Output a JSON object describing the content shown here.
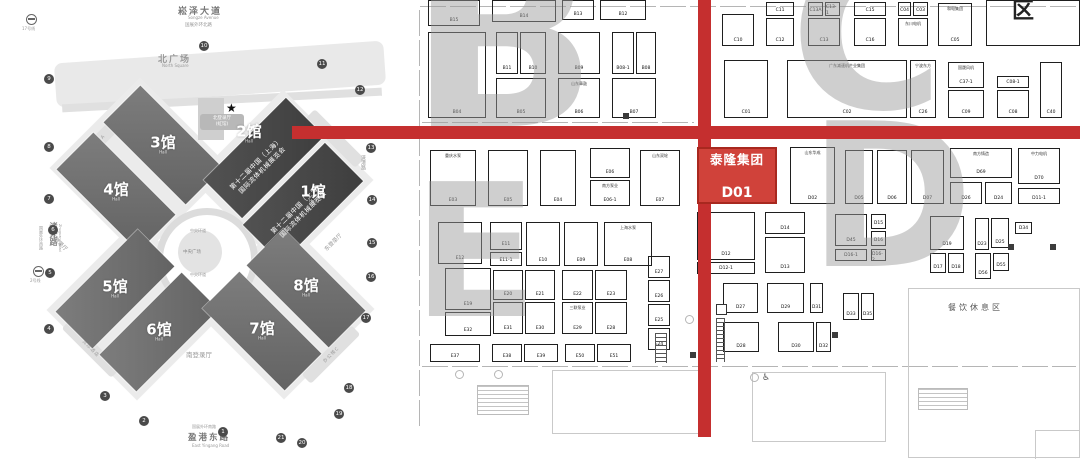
{
  "page": {
    "background": "#ffffff",
    "accent_red": "#c52f2f",
    "booth_red": "#d0423a"
  },
  "left_map": {
    "roads": {
      "top": "崧泽大道",
      "top_en": "Songze Avenue",
      "top_ring": "国展外环北路",
      "left": "诸光路",
      "left_en": "Zhuguang Road",
      "left_ring": "国展外环西路",
      "right": "涞港路",
      "bottom_ring": "国展外环南路",
      "bottom": "盈港东路",
      "bottom_en": "East Yingang Road"
    },
    "squares": {
      "north": "北广场",
      "north_en": "North Square"
    },
    "plaza": {
      "name": "中央广场",
      "ring": "中央环道"
    },
    "entrances": {
      "north_line1": "北登录厅",
      "north_line2": "(虹馆)",
      "south": "南登录厅",
      "east": "东登录厅",
      "west": "西登录厅"
    },
    "buildings": {
      "office_a": "办公楼A",
      "office_c": "办公楼C",
      "hotel": "洲际酒店"
    },
    "metro": {
      "line17": "17号线",
      "line2": "2号线"
    },
    "expo": {
      "line1": "第十二届中国（上海）",
      "line2": "国际流体机械展览会"
    },
    "halls": [
      {
        "label": "3馆",
        "sub": "Hall",
        "cx": 163,
        "cy": 145,
        "w": 116,
        "h": 52,
        "rot": 45,
        "dark": false
      },
      {
        "label": "4馆",
        "sub": "Hall",
        "cx": 116,
        "cy": 192,
        "w": 116,
        "h": 52,
        "rot": 45,
        "dark": false
      },
      {
        "label": "2馆",
        "sub": "Hall",
        "cx": 264,
        "cy": 158,
        "w": 116,
        "h": 54,
        "rot": -45,
        "dark": true
      },
      {
        "label": "1馆",
        "sub": "Hall",
        "cx": 303,
        "cy": 203,
        "w": 116,
        "h": 54,
        "rot": -45,
        "dark": true
      },
      {
        "label": "5馆",
        "sub": "Hall",
        "cx": 115,
        "cy": 289,
        "w": 116,
        "h": 52,
        "rot": -45,
        "dark": false
      },
      {
        "label": "6馆",
        "sub": "Hall",
        "cx": 159,
        "cy": 332,
        "w": 116,
        "h": 52,
        "rot": -45,
        "dark": false
      },
      {
        "label": "7馆",
        "sub": "Hall",
        "cx": 262,
        "cy": 331,
        "w": 116,
        "h": 52,
        "rot": 45,
        "dark": false
      },
      {
        "label": "8馆",
        "sub": "Hall",
        "cx": 306,
        "cy": 288,
        "w": 116,
        "h": 52,
        "rot": 45,
        "dark": false
      }
    ],
    "hall_label_pos": [
      [
        163,
        145
      ],
      [
        116,
        192
      ],
      [
        249,
        134
      ],
      [
        313,
        194
      ],
      [
        115,
        289
      ],
      [
        159,
        332
      ],
      [
        262,
        331
      ],
      [
        306,
        288
      ]
    ],
    "expo_title_pos": [
      [
        259,
        167
      ],
      [
        300,
        211
      ]
    ],
    "gates": [
      [
        "10",
        204,
        46
      ],
      [
        "11",
        322,
        64
      ],
      [
        "12",
        360,
        90
      ],
      [
        "13",
        371,
        148
      ],
      [
        "14",
        372,
        200
      ],
      [
        "15",
        372,
        243
      ],
      [
        "16",
        371,
        277
      ],
      [
        "17",
        366,
        318
      ],
      [
        "18",
        349,
        388
      ],
      [
        "19",
        339,
        414
      ],
      [
        "20",
        302,
        443
      ],
      [
        "21",
        281,
        438
      ],
      [
        "1",
        223,
        432
      ],
      [
        "2",
        144,
        421
      ],
      [
        "3",
        105,
        396
      ],
      [
        "4",
        49,
        329
      ],
      [
        "5",
        50,
        273
      ],
      [
        "6",
        53,
        230
      ],
      [
        "7",
        49,
        199
      ],
      [
        "8",
        49,
        147
      ],
      [
        "9",
        49,
        79
      ]
    ]
  },
  "right_map": {
    "highlight": {
      "name": "泰隆集团",
      "id": "D01"
    },
    "rest_area": "餐饮休息区",
    "corner_label": "区",
    "zone_letters": [
      {
        "ch": "B",
        "x": 408,
        "y": -60,
        "size": 250
      },
      {
        "ch": "C",
        "x": 790,
        "y": -48,
        "size": 210
      },
      {
        "ch": "D",
        "x": 808,
        "y": 118,
        "size": 200
      },
      {
        "ch": "E",
        "x": 412,
        "y": 178,
        "size": 185
      }
    ],
    "booths": [
      [
        "B15",
        "",
        428,
        0,
        52,
        26,
        ""
      ],
      [
        "B14",
        "",
        492,
        0,
        64,
        22,
        ""
      ],
      [
        "B13",
        "",
        562,
        0,
        32,
        20,
        ""
      ],
      [
        "B12",
        "",
        600,
        0,
        46,
        20,
        ""
      ],
      [
        "B04",
        "",
        428,
        32,
        58,
        86,
        ""
      ],
      [
        "B11",
        "",
        496,
        32,
        22,
        42,
        ""
      ],
      [
        "B10",
        "",
        520,
        32,
        26,
        42,
        ""
      ],
      [
        "B05",
        "",
        496,
        78,
        50,
        40,
        ""
      ],
      [
        "B09",
        "",
        558,
        32,
        42,
        42,
        ""
      ],
      [
        "B06",
        "山东章鼓",
        558,
        78,
        42,
        40,
        ""
      ],
      [
        "B08-1",
        "",
        612,
        32,
        22,
        42,
        ""
      ],
      [
        "B08",
        "",
        636,
        32,
        20,
        42,
        ""
      ],
      [
        "B07",
        "",
        612,
        78,
        44,
        40,
        ""
      ],
      [
        "C10",
        "",
        722,
        14,
        32,
        32,
        ""
      ],
      [
        "C11",
        "",
        766,
        2,
        28,
        14,
        ""
      ],
      [
        "C12",
        "",
        766,
        18,
        28,
        28,
        ""
      ],
      [
        "C13A",
        "",
        808,
        2,
        15,
        14,
        ""
      ],
      [
        "C13-1",
        "",
        825,
        2,
        15,
        14,
        ""
      ],
      [
        "C13",
        "",
        808,
        18,
        32,
        28,
        ""
      ],
      [
        "C15",
        "",
        854,
        2,
        32,
        14,
        ""
      ],
      [
        "C16",
        "",
        854,
        18,
        32,
        28,
        ""
      ],
      [
        "C04",
        "",
        898,
        2,
        13,
        14,
        ""
      ],
      [
        "C03",
        "",
        913,
        2,
        15,
        14,
        ""
      ],
      [
        "",
        "东川电机",
        898,
        18,
        30,
        28,
        ""
      ],
      [
        "C05",
        "和电集团",
        938,
        3,
        34,
        43,
        ""
      ],
      [
        "",
        "",
        986,
        0,
        94,
        46,
        ""
      ],
      [
        "C01",
        "",
        724,
        60,
        44,
        58,
        ""
      ],
      [
        "C02",
        "广东减速机产业集团",
        787,
        60,
        120,
        58,
        ""
      ],
      [
        "C26",
        "宁波东方",
        910,
        60,
        26,
        58,
        ""
      ],
      [
        "C37-1",
        "国晟风机",
        948,
        62,
        36,
        26,
        ""
      ],
      [
        "C09",
        "",
        948,
        90,
        36,
        28,
        ""
      ],
      [
        "C08-1",
        "",
        997,
        76,
        32,
        12,
        ""
      ],
      [
        "C08",
        "",
        997,
        90,
        32,
        28,
        ""
      ],
      [
        "C40",
        "",
        1040,
        62,
        22,
        56,
        ""
      ],
      [
        "D01",
        "泰隆集团",
        697,
        147,
        80,
        57,
        "red"
      ],
      [
        "D02",
        "山东华成",
        790,
        147,
        45,
        57,
        ""
      ],
      [
        "D05",
        "",
        845,
        150,
        28,
        54,
        ""
      ],
      [
        "D06",
        "",
        877,
        150,
        30,
        54,
        ""
      ],
      [
        "D07",
        "",
        911,
        150,
        33,
        54,
        ""
      ],
      [
        "D69",
        "南方铸造",
        950,
        148,
        62,
        30,
        ""
      ],
      [
        "D26",
        "",
        950,
        182,
        32,
        22,
        ""
      ],
      [
        "D24",
        "",
        985,
        182,
        27,
        22,
        ""
      ],
      [
        "D70",
        "中力电机",
        1018,
        148,
        42,
        36,
        ""
      ],
      [
        "D11-1",
        "",
        1018,
        188,
        42,
        16,
        ""
      ],
      [
        "D12",
        "",
        697,
        212,
        58,
        48,
        ""
      ],
      [
        "D12-1",
        "",
        697,
        262,
        58,
        12,
        ""
      ],
      [
        "D14",
        "",
        765,
        212,
        40,
        22,
        ""
      ],
      [
        "D13",
        "",
        765,
        237,
        40,
        36,
        ""
      ],
      [
        "D45",
        "",
        835,
        214,
        32,
        32,
        ""
      ],
      [
        "D15",
        "",
        871,
        214,
        15,
        15,
        ""
      ],
      [
        "D16",
        "",
        871,
        231,
        15,
        15,
        ""
      ],
      [
        "D16-1",
        "",
        835,
        249,
        32,
        12,
        ""
      ],
      [
        "D16-2",
        "",
        871,
        249,
        15,
        12,
        ""
      ],
      [
        "D19",
        "",
        930,
        216,
        34,
        34,
        ""
      ],
      [
        "D17",
        "",
        930,
        253,
        16,
        20,
        ""
      ],
      [
        "D18",
        "",
        948,
        253,
        16,
        20,
        ""
      ],
      [
        "D23",
        "",
        975,
        218,
        14,
        32,
        ""
      ],
      [
        "D25",
        "",
        991,
        218,
        18,
        30,
        ""
      ],
      [
        "D56",
        "",
        975,
        253,
        16,
        26,
        ""
      ],
      [
        "D55",
        "",
        993,
        253,
        16,
        18,
        ""
      ],
      [
        "D34",
        "",
        1015,
        222,
        17,
        12,
        ""
      ],
      [
        "D27",
        "",
        723,
        283,
        35,
        30,
        ""
      ],
      [
        "D29",
        "",
        767,
        283,
        37,
        30,
        ""
      ],
      [
        "D31",
        "",
        810,
        283,
        13,
        30,
        ""
      ],
      [
        "D28",
        "",
        723,
        322,
        36,
        30,
        ""
      ],
      [
        "D30",
        "",
        778,
        322,
        36,
        30,
        ""
      ],
      [
        "D32",
        "",
        816,
        322,
        15,
        30,
        ""
      ],
      [
        "D33",
        "",
        843,
        293,
        16,
        27,
        ""
      ],
      [
        "D35",
        "",
        861,
        293,
        13,
        27,
        ""
      ],
      [
        "E03",
        "重庆水泵",
        430,
        150,
        46,
        56,
        ""
      ],
      [
        "E05",
        "",
        488,
        150,
        40,
        56,
        ""
      ],
      [
        "E04",
        "",
        540,
        150,
        36,
        56,
        ""
      ],
      [
        "E06",
        "",
        590,
        148,
        40,
        30,
        ""
      ],
      [
        "E06-1",
        "南方泵业",
        590,
        180,
        40,
        26,
        ""
      ],
      [
        "E07",
        "山东双轮",
        640,
        150,
        40,
        56,
        ""
      ],
      [
        "E12",
        "",
        438,
        222,
        44,
        42,
        ""
      ],
      [
        "E11",
        "",
        490,
        222,
        32,
        28,
        ""
      ],
      [
        "E11-1",
        "",
        490,
        252,
        32,
        14,
        ""
      ],
      [
        "E10",
        "",
        526,
        222,
        34,
        44,
        ""
      ],
      [
        "E09",
        "",
        564,
        222,
        34,
        44,
        ""
      ],
      [
        "E08",
        "上海水泵",
        604,
        222,
        48,
        44,
        ""
      ],
      [
        "E19",
        "",
        445,
        268,
        46,
        42,
        ""
      ],
      [
        "E32",
        "",
        445,
        312,
        46,
        24,
        ""
      ],
      [
        "E20",
        "",
        493,
        270,
        30,
        30,
        ""
      ],
      [
        "E21",
        "",
        525,
        270,
        30,
        30,
        ""
      ],
      [
        "E31",
        "",
        493,
        302,
        30,
        32,
        ""
      ],
      [
        "E30",
        "",
        525,
        302,
        30,
        32,
        ""
      ],
      [
        "E22",
        "",
        562,
        270,
        31,
        30,
        ""
      ],
      [
        "E23",
        "",
        595,
        270,
        32,
        30,
        ""
      ],
      [
        "E29",
        "三联泵业",
        562,
        302,
        31,
        32,
        ""
      ],
      [
        "E28",
        "",
        595,
        302,
        32,
        32,
        ""
      ],
      [
        "E37",
        "",
        430,
        344,
        50,
        18,
        ""
      ],
      [
        "E38",
        "",
        492,
        344,
        30,
        18,
        ""
      ],
      [
        "E39",
        "",
        524,
        344,
        34,
        18,
        ""
      ],
      [
        "E50",
        "",
        565,
        344,
        30,
        18,
        ""
      ],
      [
        "E51",
        "",
        597,
        344,
        34,
        18,
        ""
      ],
      [
        "E27",
        "",
        648,
        256,
        22,
        22,
        ""
      ],
      [
        "E26",
        "",
        648,
        280,
        22,
        22,
        ""
      ],
      [
        "E25",
        "",
        648,
        304,
        22,
        22,
        ""
      ],
      [
        "E24",
        "",
        648,
        328,
        22,
        22,
        ""
      ]
    ],
    "pillars": [
      [
        832,
        332
      ],
      [
        1008,
        244
      ],
      [
        1050,
        244
      ],
      [
        690,
        352
      ],
      [
        623,
        113
      ]
    ]
  }
}
